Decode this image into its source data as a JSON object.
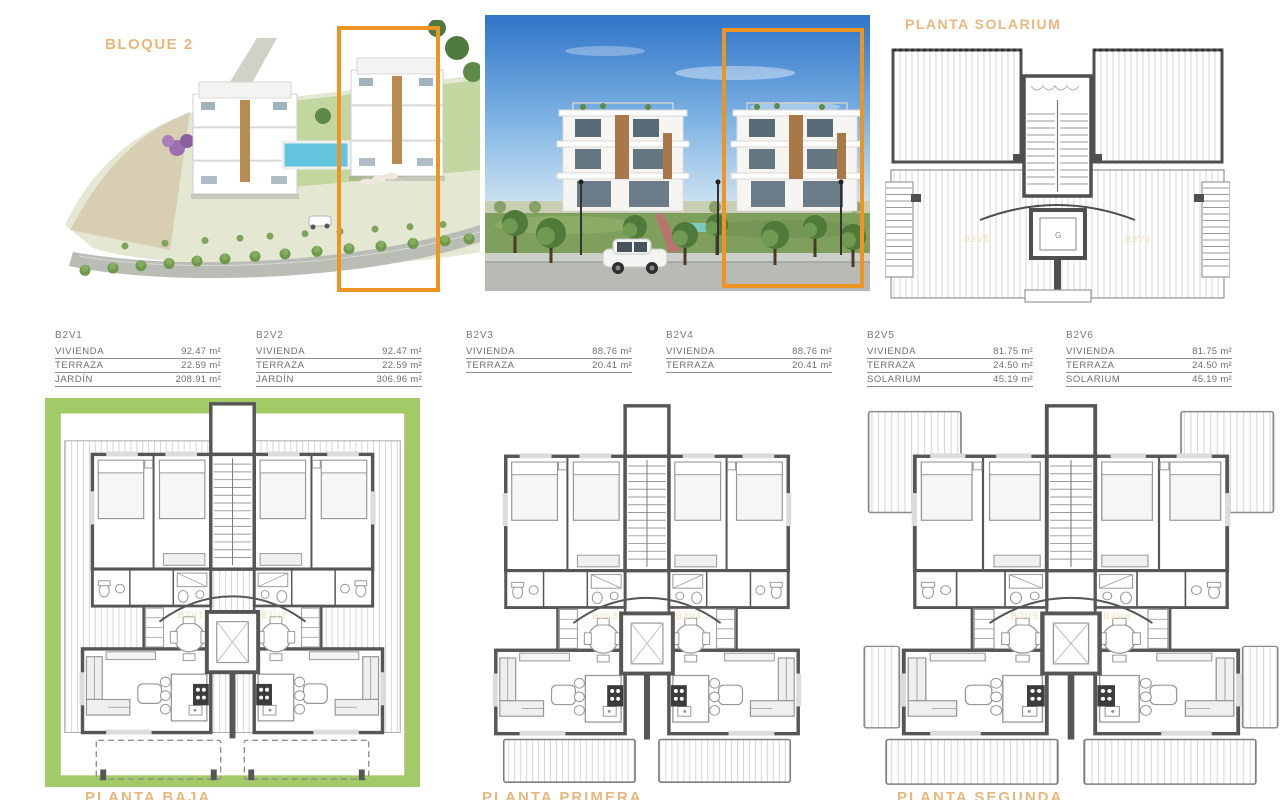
{
  "document": {
    "block_title": "BLOQUE 2",
    "solarium_title": "PLANTA SOLARIUM"
  },
  "colors": {
    "accent_orange": "#EE9422",
    "title_orange": "#E9B77C",
    "faint_label_orange": "#F2DFAE",
    "garden_green": "#A2CA67",
    "wall_gray": "#565656"
  },
  "units": [
    {
      "code": "B2V1",
      "rows": [
        {
          "label": "VIVIENDA",
          "value": "92.47 m²"
        },
        {
          "label": "TERRAZA",
          "value": "22.59 m²"
        },
        {
          "label": "JARDÍN",
          "value": "208.91 m²"
        }
      ]
    },
    {
      "code": "B2V2",
      "rows": [
        {
          "label": "VIVIENDA",
          "value": "92.47 m²"
        },
        {
          "label": "TERRAZA",
          "value": "22.59 m²"
        },
        {
          "label": "JARDÍN",
          "value": "306.96 m²"
        }
      ]
    },
    {
      "code": "B2V3",
      "rows": [
        {
          "label": "VIVIENDA",
          "value": "88.76 m²"
        },
        {
          "label": "TERRAZA",
          "value": "20.41 m²"
        }
      ]
    },
    {
      "code": "B2V4",
      "rows": [
        {
          "label": "VIVIENDA",
          "value": "88.76 m²"
        },
        {
          "label": "TERRAZA",
          "value": "20.41 m²"
        }
      ]
    },
    {
      "code": "B2V5",
      "rows": [
        {
          "label": "VIVIENDA",
          "value": "81.75 m²"
        },
        {
          "label": "TERRAZA",
          "value": "24.50 m²"
        },
        {
          "label": "SOLARIUM",
          "value": "45.19 m²"
        }
      ]
    },
    {
      "code": "B2V6",
      "rows": [
        {
          "label": "VIVIENDA",
          "value": "81.75 m²"
        },
        {
          "label": "TERRAZA",
          "value": "24.50 m²"
        },
        {
          "label": "SOLARIUM",
          "value": "45.19 m²"
        }
      ]
    }
  ],
  "floorplans": [
    {
      "id": "baja",
      "title": "PLANTA BAJA",
      "unit_labels": [
        "B2V1",
        "B2V2"
      ]
    },
    {
      "id": "primera",
      "title": "PLANTA PRIMERA",
      "unit_labels": [
        "B2V3",
        "B2V4"
      ]
    },
    {
      "id": "segunda",
      "title": "PLANTA SEGUNDA",
      "unit_labels": [
        "B2V5",
        "B2V6"
      ]
    }
  ],
  "solarium_plan": {
    "unit_labels": [
      "B2V5",
      "B2V6"
    ]
  }
}
